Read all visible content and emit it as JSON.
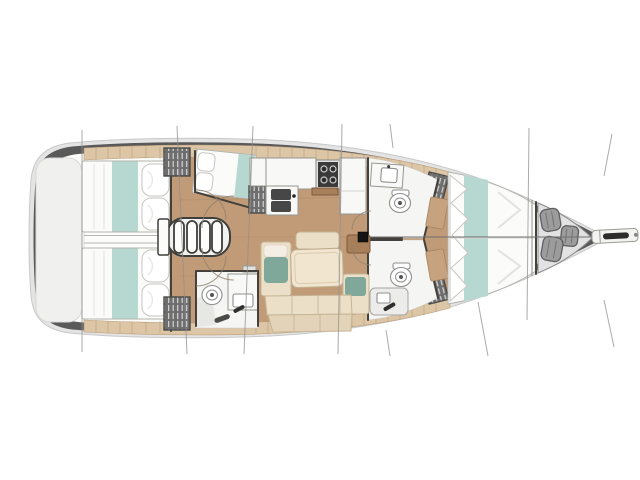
{
  "diagram": {
    "kind": "sailing-yacht-interior-floorplan",
    "orientation": "bow-right",
    "areas": [
      {
        "id": "swim-platform",
        "label": "stern platform"
      },
      {
        "id": "cabin-aft-port",
        "label": "aft port double cabin"
      },
      {
        "id": "cabin-aft-starboard",
        "label": "aft starboard double cabin"
      },
      {
        "id": "engine-compartment",
        "label": "engine space between aft cabins"
      },
      {
        "id": "companionway-stairs",
        "label": "companionway steps"
      },
      {
        "id": "cabin-mid-port",
        "label": "mid port berth cabin"
      },
      {
        "id": "galley",
        "label": "galley with stove and twin sinks"
      },
      {
        "id": "head-aft",
        "label": "aft head with toilet and basin"
      },
      {
        "id": "head-forward-port",
        "label": "forward port head"
      },
      {
        "id": "head-forward-starboard",
        "label": "forward starboard head with shower"
      },
      {
        "id": "salon",
        "label": "saloon settee and table"
      },
      {
        "id": "mast",
        "label": "mast foot"
      },
      {
        "id": "cabin-forward-vberth",
        "label": "forward V-berth cabin"
      },
      {
        "id": "sail-locker",
        "label": "bow sail locker with fenders"
      },
      {
        "id": "bowsprit",
        "label": "bowsprit / anchor roller"
      },
      {
        "id": "rigging-lines",
        "label": "rig and section lines"
      }
    ]
  },
  "palette": {
    "hull_rim": "#e4e4e4",
    "hull_rim_stroke": "#c8c8c8",
    "hull_band": "#595959",
    "deck": "#fbfbfa",
    "platform": "#f0f0ee",
    "floor_wood": "#c19b77",
    "floor_wood_dark": "#a9845f",
    "cabinet_tan": "#ddc6a6",
    "cabinet_tan_stroke": "#b89d7a",
    "counter_white": "#f8f8f6",
    "counter_stroke": "#96968f",
    "bed_white": "#fbfbfa",
    "bed_stroke": "#b3b3ae",
    "teal_light": "#b7d8d0",
    "teal_dark": "#7fa89a",
    "sofa_cream": "#ecdfc8",
    "sofa_cream_dark": "#e3d3b8",
    "sofa_stroke": "#c5b495",
    "wood_brown": "#a87f5b",
    "stove_dark": "#3a3a3a",
    "sink_dark": "#474747",
    "locker_dark": "#6e6e6e",
    "locker_hatch": "#d6d6d6",
    "fixture_stroke": "#8f8f8f",
    "wall_dark": "#44413c",
    "fender_gray": "#9c9c9c",
    "fender_stroke": "#5f5f5f",
    "rig_line": "#8f8f8f",
    "mast_black": "#141414"
  }
}
